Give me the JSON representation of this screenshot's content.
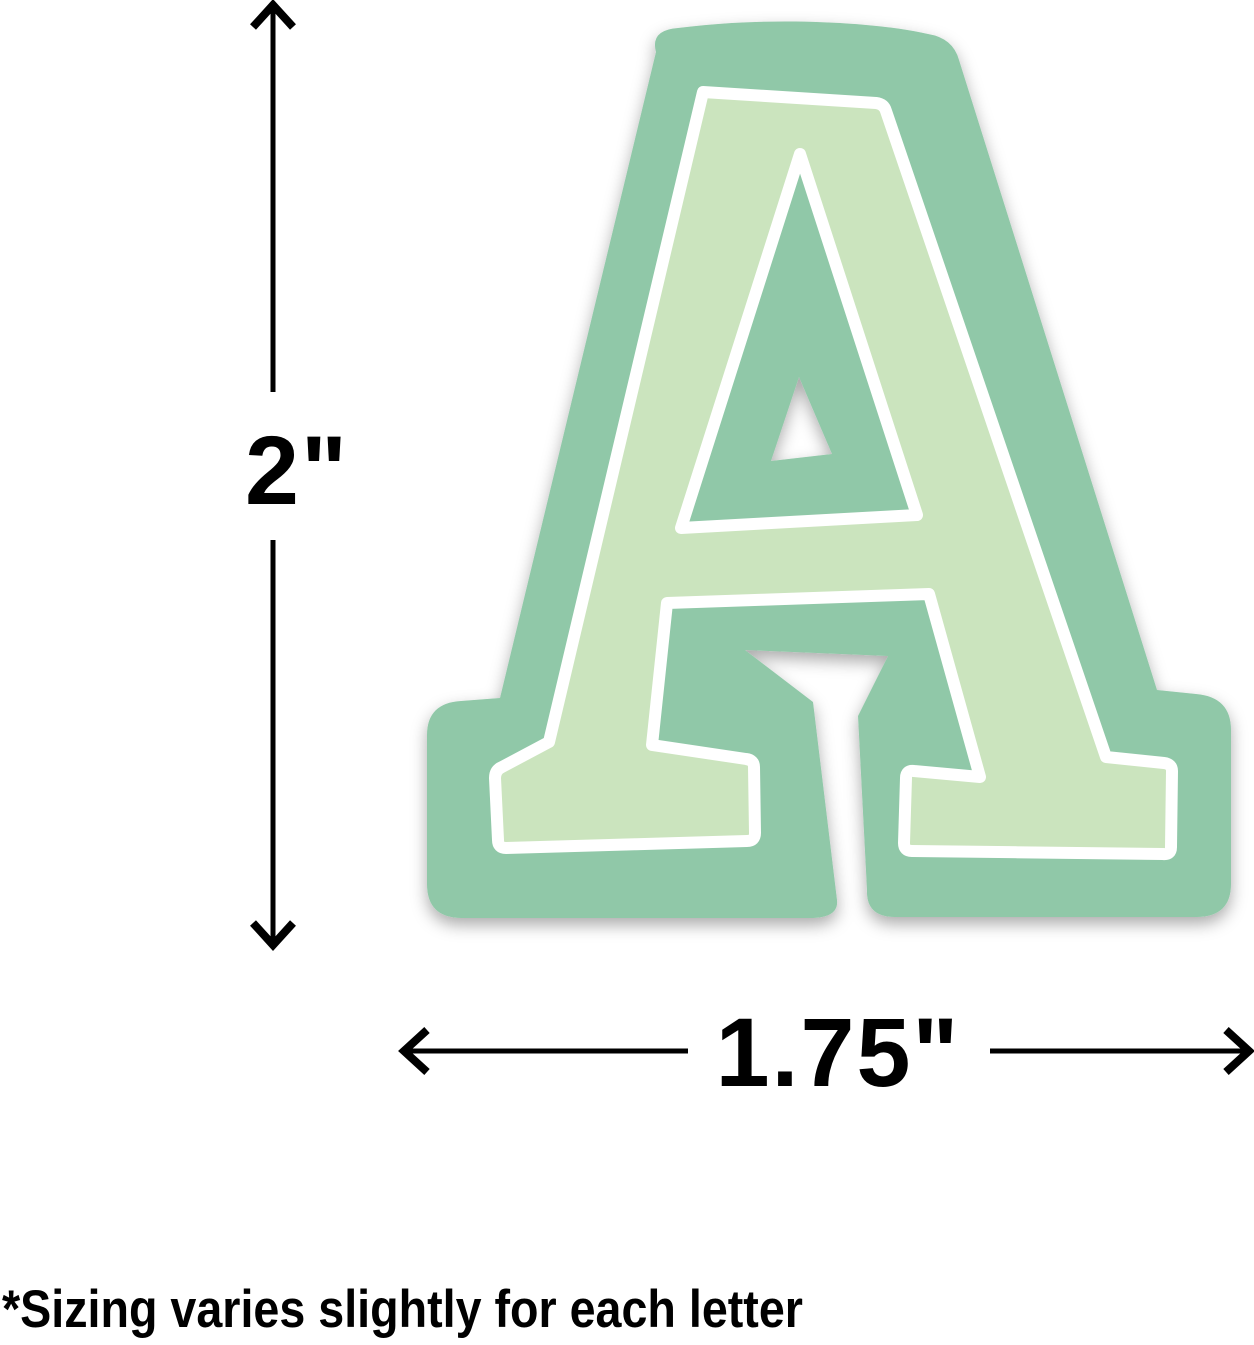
{
  "product_diagram": {
    "letter": "A",
    "height_label": "2\"",
    "width_label": "1.75\"",
    "note": "*Sizing varies slightly for each letter",
    "colors": {
      "sticker_green": "#90C8A8",
      "letter_fill_green": "#CBE4BE",
      "outline_white": "#FFFFFF",
      "dimension_black": "#000000"
    }
  }
}
